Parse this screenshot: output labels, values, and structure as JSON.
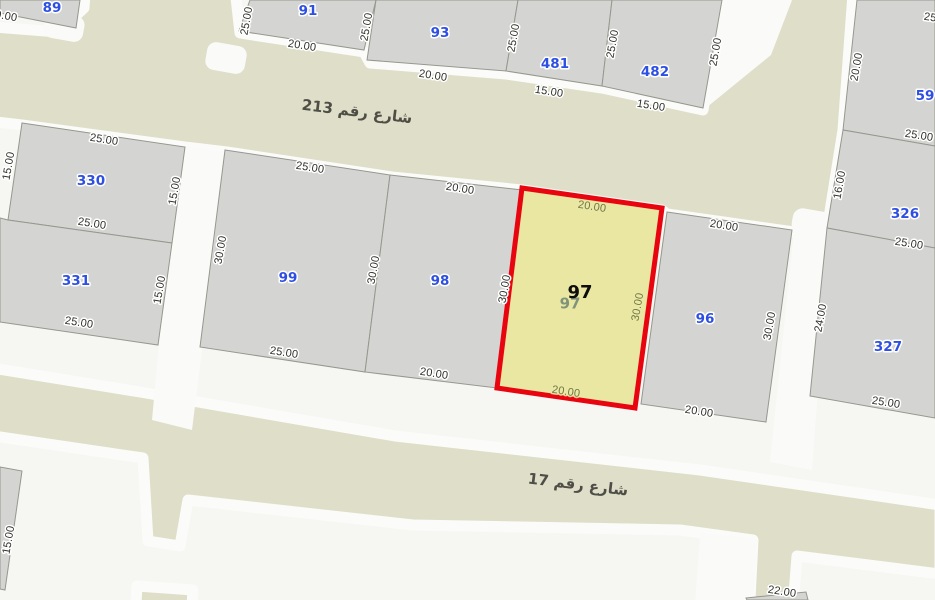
{
  "map": {
    "title": "Parcel map with highlighted plot 97",
    "canvas": {
      "width": 935,
      "height": 600
    },
    "colors": {
      "background": "#f6f6f3",
      "street_fill": "#dfdec8",
      "street_casing": "#fbfbf9",
      "white_street": "#fafaf8",
      "parcel_fill": "#d4d4d2",
      "parcel_stroke": "#97978f",
      "dim_text": "#2e2e28",
      "dim_halo": "#ffffff",
      "parcel_number": "#2e4fe3",
      "highlight_fill": "#eae7a2",
      "highlight_stroke": "#e8050f",
      "yellow_dim_text": "#6f7549",
      "yellow_dim_halo": "rgba(234,231,162,0.85)",
      "ghost_number": "#7f9478",
      "street_text": "#4e4e46",
      "hl_number_color": "#0d0d0d"
    },
    "streets": [
      {
        "name": "شارع رقم 213",
        "label_x": 357,
        "label_y": 112,
        "rot": 7
      },
      {
        "name": "شارع رقم 17",
        "label_x": 578,
        "label_y": 485,
        "rot": 7
      }
    ],
    "olive_polygons": [
      {
        "id": "street-213-band",
        "pts": "-20,26 58,32 84,8 86,-20 234,-20 240,33 364,52 370,63 506,74 602,88 703,110 718,24 722,-20 790,-20 854,-20 843,130 827,230 794,232 667,214 662,210 522,190 392,177 227,152 185,147 22,125 -20,120"
      },
      {
        "id": "street-17-band",
        "pts": "-20,366 140,392 395,436 700,470 940,505 940,574 797,556 792,620 749,620 753,540 680,530 413,525 188,500 180,546 148,541 143,458 -20,434"
      },
      {
        "id": "street-17-stub",
        "pts": "137,586 193,590 191,620 135,620"
      }
    ],
    "white_shapes": [
      {
        "id": "junction-notch-left",
        "type": "rect",
        "x": 44,
        "y": 14,
        "w": 40,
        "h": 26,
        "rx": 9,
        "rot": "10 64 27"
      },
      {
        "id": "junction-notch-mid",
        "type": "rect",
        "x": 206,
        "y": 44,
        "w": 40,
        "h": 28,
        "rx": 9,
        "rot": "10 226 58"
      },
      {
        "id": "junction-notch-right",
        "type": "rect",
        "x": 792,
        "y": 210,
        "w": 40,
        "h": 26,
        "rx": 10,
        "rot": "10 812 223"
      },
      {
        "id": "white-street-ne",
        "type": "poly",
        "pts": "718,-5 794,-5 771,55 701,112"
      },
      {
        "id": "white-street-mid",
        "type": "poly",
        "pts": "177,145 227,152 192,430 152,420"
      },
      {
        "id": "white-street-right",
        "type": "poly",
        "pts": "794,231 830,227 812,470 770,462"
      },
      {
        "id": "white-street-bottom",
        "type": "poly",
        "pts": "700,533 757,539 752,620 694,620"
      }
    ],
    "parcels": [
      {
        "number": "89",
        "pts": "0,0 80,0 76,28 0,13",
        "lx": 52,
        "ly": 8
      },
      {
        "number": "91",
        "pts": "250,0 376,0 364,50 239,31",
        "lx": 308,
        "ly": 11
      },
      {
        "number": "93",
        "pts": "376,0 518,0 506,71 367,60",
        "lx": 440,
        "ly": 33
      },
      {
        "number": "481",
        "pts": "518,0 612,0 602,86 506,71",
        "lx": 555,
        "ly": 64
      },
      {
        "number": "482",
        "pts": "612,0 722,0 703,108 602,86",
        "lx": 655,
        "ly": 72
      },
      {
        "number": "59",
        "pts": "857,0 935,0 935,146 843,130",
        "lx": 925,
        "ly": 96
      },
      {
        "number": "326",
        "pts": "843,130 935,146 935,248 827,228",
        "lx": 905,
        "ly": 214
      },
      {
        "number": "327",
        "pts": "827,228 935,248 935,418 810,396",
        "lx": 888,
        "ly": 347
      },
      {
        "number": "330",
        "pts": "22,123 185,147 172,243 8,220",
        "lx": 91,
        "ly": 181
      },
      {
        "number": "331",
        "pts": "0,218 8,220 172,243 158,345 0,322",
        "lx": 76,
        "ly": 281
      },
      {
        "number": "99",
        "pts": "225,150 390,175 365,372 200,347",
        "lx": 288,
        "ly": 278
      },
      {
        "number": "98",
        "pts": "390,175 522,190 497,388 365,372",
        "lx": 440,
        "ly": 281
      },
      {
        "number": "96",
        "pts": "667,212 792,230 766,422 641,404",
        "lx": 705,
        "ly": 319
      },
      {
        "number": "",
        "pts": "0,467 22,471 5,590 0,589",
        "lx": 0,
        "ly": 0
      },
      {
        "number": "",
        "pts": "746,598 806,592 808,600 747,600",
        "lx": 0,
        "ly": 0
      }
    ],
    "highlight": {
      "number": "97",
      "pts": "522,188 662,208 635,408 497,388",
      "bold_label": {
        "text": "97",
        "x": 580,
        "y": 293,
        "size": 18
      },
      "ghost_label": {
        "text": "97",
        "x": 570,
        "y": 304,
        "size": 15
      },
      "inner_dims": [
        {
          "t": "20.00",
          "x": 592,
          "y": 207,
          "r": 9
        },
        {
          "t": "30.00",
          "x": 638,
          "y": 307,
          "r": -80
        },
        {
          "t": "20.00",
          "x": 566,
          "y": 392,
          "r": 9
        }
      ]
    },
    "dims": [
      {
        "t": "20.00",
        "x": 3,
        "y": 16,
        "r": 10
      },
      {
        "t": "25.00",
        "x": 247,
        "y": 21,
        "r": -80
      },
      {
        "t": "20.00",
        "x": 302,
        "y": 46,
        "r": 9
      },
      {
        "t": "25.00",
        "x": 367,
        "y": 27,
        "r": -80
      },
      {
        "t": "25.00",
        "x": 514,
        "y": 38,
        "r": -80
      },
      {
        "t": "20.00",
        "x": 433,
        "y": 76,
        "r": 9
      },
      {
        "t": "25.00",
        "x": 613,
        "y": 44,
        "r": -80
      },
      {
        "t": "15.00",
        "x": 549,
        "y": 92,
        "r": 9
      },
      {
        "t": "25.00",
        "x": 716,
        "y": 52,
        "r": -80
      },
      {
        "t": "15.00",
        "x": 651,
        "y": 106,
        "r": 9
      },
      {
        "t": "25.00",
        "x": 938,
        "y": 19,
        "r": 9
      },
      {
        "t": "20.00",
        "x": 857,
        "y": 67,
        "r": -80
      },
      {
        "t": "25.00",
        "x": 919,
        "y": 136,
        "r": 9
      },
      {
        "t": "16.00",
        "x": 840,
        "y": 185,
        "r": -80
      },
      {
        "t": "25.00",
        "x": 909,
        "y": 244,
        "r": 9
      },
      {
        "t": "24.00",
        "x": 821,
        "y": 318,
        "r": -80
      },
      {
        "t": "25.00",
        "x": 886,
        "y": 403,
        "r": 9
      },
      {
        "t": "25.00",
        "x": 104,
        "y": 140,
        "r": 9
      },
      {
        "t": "15.00",
        "x": 9,
        "y": 166,
        "r": -80
      },
      {
        "t": "15.00",
        "x": 175,
        "y": 191,
        "r": -80
      },
      {
        "t": "25.00",
        "x": 92,
        "y": 224,
        "r": 9
      },
      {
        "t": "15.00",
        "x": 160,
        "y": 290,
        "r": -80
      },
      {
        "t": "25.00",
        "x": 79,
        "y": 323,
        "r": 9
      },
      {
        "t": "25.00",
        "x": 310,
        "y": 168,
        "r": 9
      },
      {
        "t": "30.00",
        "x": 221,
        "y": 250,
        "r": -80
      },
      {
        "t": "30.00",
        "x": 374,
        "y": 270,
        "r": -80
      },
      {
        "t": "25.00",
        "x": 284,
        "y": 353,
        "r": 9
      },
      {
        "t": "20.00",
        "x": 460,
        "y": 189,
        "r": 9
      },
      {
        "t": "20.00",
        "x": 434,
        "y": 374,
        "r": 9
      },
      {
        "t": "30.00",
        "x": 505,
        "y": 289,
        "r": -80
      },
      {
        "t": "20.00",
        "x": 724,
        "y": 226,
        "r": 9
      },
      {
        "t": "30.00",
        "x": 770,
        "y": 326,
        "r": -80
      },
      {
        "t": "20.00",
        "x": 699,
        "y": 412,
        "r": 9
      },
      {
        "t": "15.00",
        "x": 9,
        "y": 540,
        "r": -80
      },
      {
        "t": "22.00",
        "x": 782,
        "y": 592,
        "r": 9
      }
    ]
  }
}
